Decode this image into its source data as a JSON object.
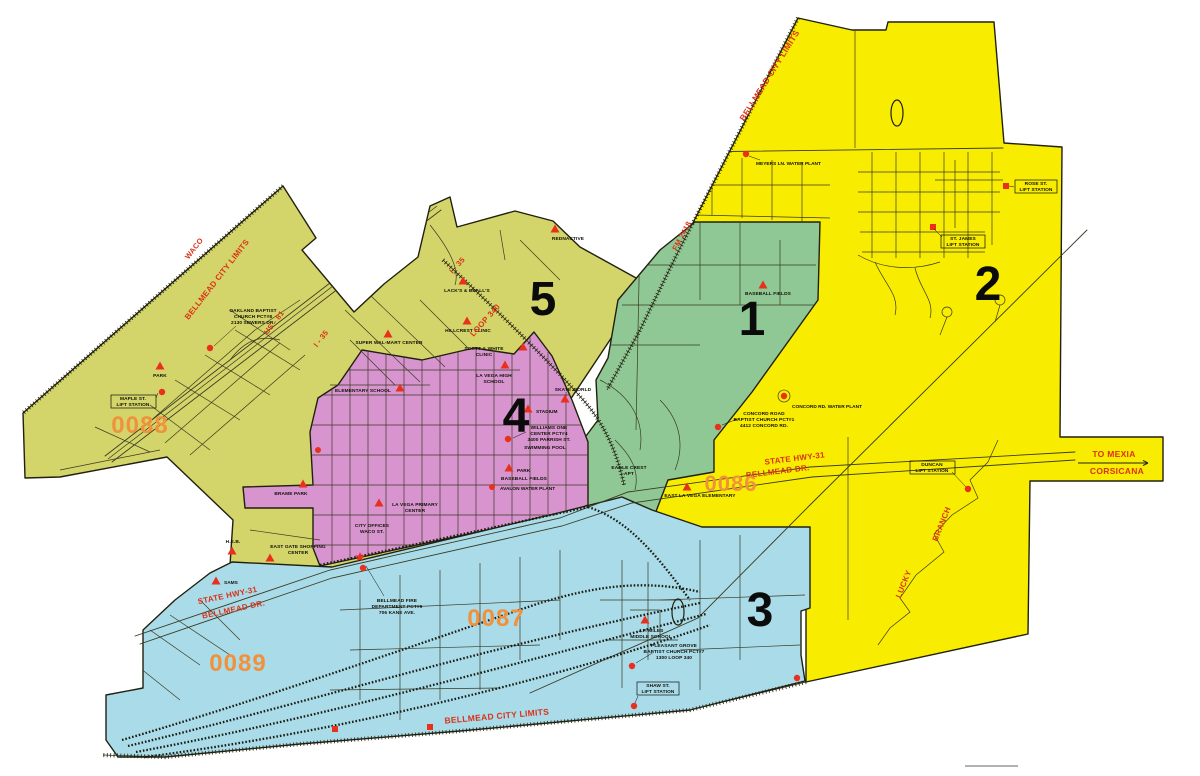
{
  "map": {
    "colors": {
      "district_1_green": "#8fc795",
      "district_2_yellow": "#f8ec00",
      "district_3_blue": "#a9dbe9",
      "district_4_pink": "#d794cf",
      "district_5_olive": "#d3d469",
      "marker_red": "#e8301d",
      "road_label_red": "#d93318",
      "precinct_orange": "#f1913c"
    },
    "district_numbers": {
      "d1": "1",
      "d2": "2",
      "d3": "3",
      "d4": "4",
      "d5": "5"
    },
    "precinct_codes": {
      "p0086": "0086",
      "p0087": "0087",
      "p0088": "0088",
      "p0089": "0089"
    },
    "road_labels": {
      "waco": "WACO",
      "bellmead_city_limits": "BELLMEAD CITY LIMITS",
      "us_81": "US - 81",
      "i_35": "I - 35",
      "loop_340": "LOOP 340",
      "fm_2418": "FM 2418",
      "state_hwy_31": "STATE HWY-31",
      "bellmead_dr": "BELLMEAD DR.",
      "lucky": "LUCKY",
      "branch": "BRANCH",
      "to_mexia": "TO MEXIA",
      "corsicana": "CORSICANA"
    },
    "pois": {
      "baseball_fields": "BASEBALL FIELDS",
      "rednactive": "REDNACTIVE",
      "lacks_bealls": "LACK'S & BEALL'S",
      "super_walmart": "SUPER WAL-MART CENTER",
      "hillcrest_clinic": "HILLCREST CLINIC",
      "scott_white_1": "SCOTT & WHITE",
      "scott_white_2": "CLINIC",
      "la_vega_high_1": "LA VEGA HIGH",
      "la_vega_high_2": "SCHOOL",
      "elementary_school": "ELEMENTARY SCHOOL",
      "skate_world": "SKATE WORLD",
      "stadium": "STADIUM",
      "park": "PARK",
      "la_vega_primary_1": "LA VEGA PRIMARY",
      "la_vega_primary_2": "CENTER",
      "brame_park": "BRAME PARK",
      "city_offices_1": "CITY OFFICES",
      "city_offices_2": "WACO ST.",
      "heb": "H.E.B.",
      "east_gate_1": "EAST GATE SHOPPING",
      "east_gate_2": "CENTER",
      "sams": "SAMS",
      "jp_miles_1": "J.P. MILES",
      "jp_miles_2": "MIDDLE SCHOOL",
      "east_la_vega": "EAST LA VEGA ELEMENTARY",
      "eagle_crest_1": "EAGLE CREST",
      "eagle_crest_2": "APT",
      "meyers_water": "MEYERS LN. WATER PLANT",
      "concord_water": "CONCORD RD. WATER PLANT",
      "avalon_water": "AVALON WATER PLANT",
      "concord_church_1": "CONCORD ROAD",
      "concord_church_2": "BAPTIST CHURCH PCT#1",
      "concord_church_3": "4412 CONCORD RD.",
      "oakland_church_1": "OAKLAND BAPTIST",
      "oakland_church_2": "CHURCH PCT#8",
      "oakland_church_3": "2130 SEWERS DR.",
      "williams_1": "WILLIAMS ONE",
      "williams_2": "CENTER PCT#4",
      "williams_3": "3400 PARRISH ST.",
      "williams_4": "SWIMMING POOL",
      "fire_dept_1": "BELLMEAD FIRE",
      "fire_dept_2": "DEPARTMENT PCT#9",
      "fire_dept_3": "706 KANE AVE.",
      "pleasant_grove_1": "PLEASANT GROVE",
      "pleasant_grove_2": "BAPTIST CHURCH PCT#7",
      "pleasant_grove_3": "1300 LOOP 340",
      "maple_lift_1": "MAPLE ST.",
      "maple_lift_2": "LIFT STATION",
      "rose_lift_1": "ROSE ST.",
      "rose_lift_2": "LIFT STATION",
      "james_lift_1": "ST. JAMES",
      "james_lift_2": "LIFT STATION",
      "duncan_lift_1": "DUNCAN",
      "duncan_lift_2": "LIFT STATION",
      "shaw_lift_1": "SHAW ST.",
      "shaw_lift_2": "LIFT STATION"
    }
  }
}
